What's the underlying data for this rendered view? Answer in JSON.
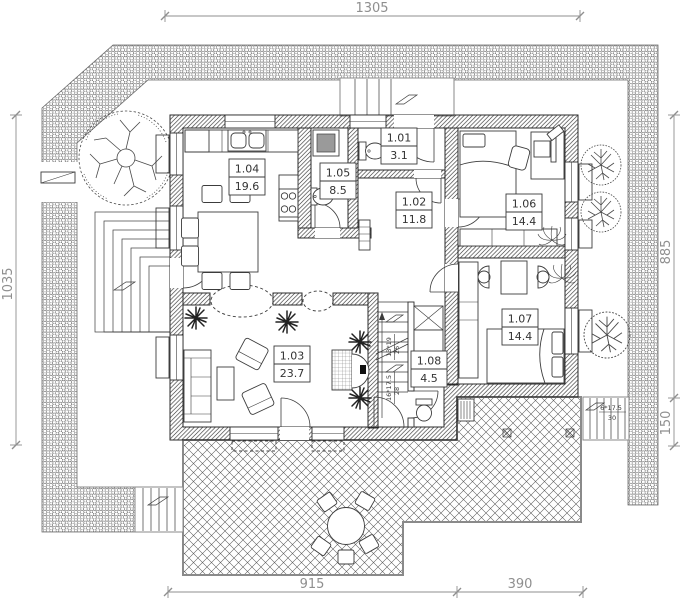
{
  "rooms": [
    {
      "number": "1.01",
      "area": "3.1"
    },
    {
      "number": "1.02",
      "area": "11.8"
    },
    {
      "number": "1.03",
      "area": "23.7"
    },
    {
      "number": "1.04",
      "area": "19.6"
    },
    {
      "number": "1.05",
      "area": "8.5"
    },
    {
      "number": "1.06",
      "area": "14.4"
    },
    {
      "number": "1.07",
      "area": "14.4"
    },
    {
      "number": "1.08",
      "area": "4.5"
    }
  ],
  "dimensions": {
    "top": "1305",
    "left": "1035",
    "right_upper": "885",
    "right_lower": "150",
    "bottom_main": "915",
    "bottom_right": "390"
  },
  "stairs": {
    "flight_upper_label": "13*19",
    "flight_upper_width": "26",
    "flight_lower_label": "16*17.5",
    "flight_lower_width": "28",
    "exterior_label": "6*17.5",
    "exterior_width": "30"
  }
}
